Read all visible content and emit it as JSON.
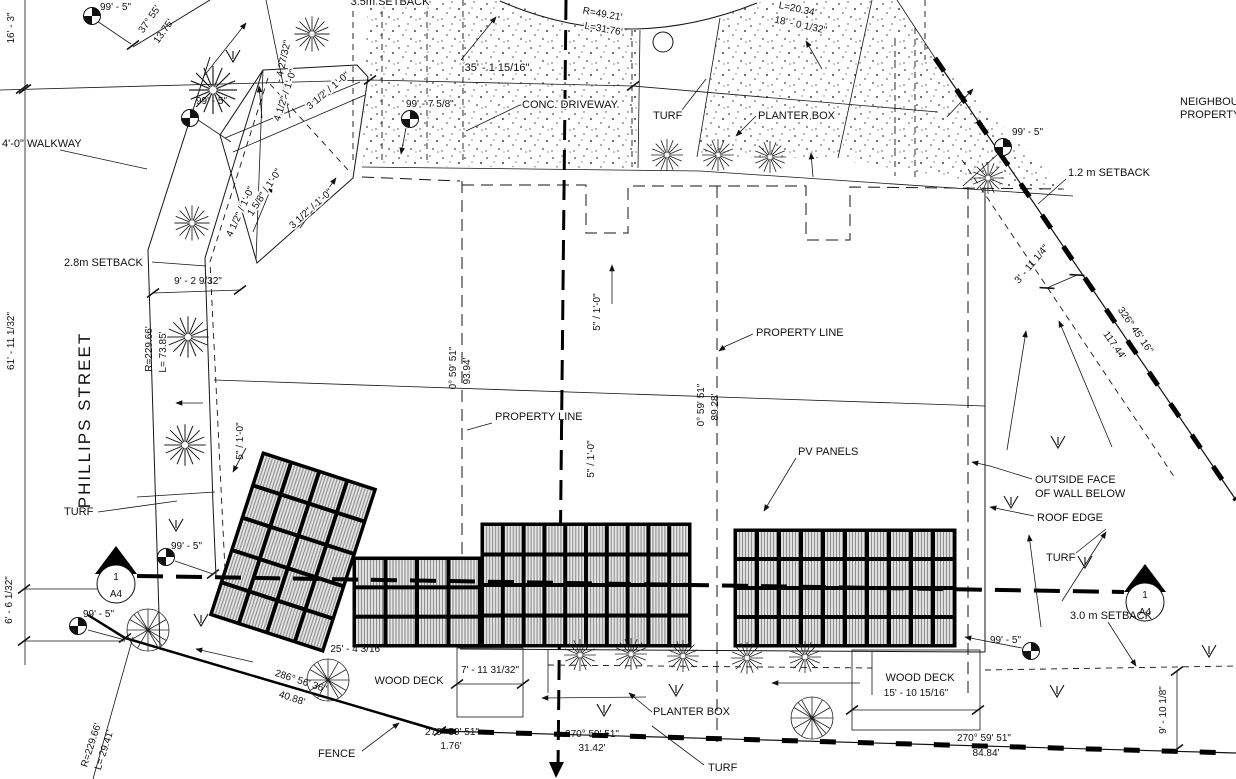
{
  "title": "Site Plan",
  "colors": {
    "ink": "#111111",
    "paper": "#ffffff",
    "panel_fill": "#e8e8e8"
  },
  "street": {
    "name": "PHILLIPS STREET"
  },
  "neighbour": {
    "line1": "NEIGHBOUR",
    "line2": "PROPERTY"
  },
  "areas": {
    "walkway": "4'-0\" WALKWAY",
    "conc_driveway": "CONC. DRIVEWAY",
    "turf": "TURF",
    "planter_box": "PLANTER BOX",
    "pv_panels": "PV PANELS",
    "wood_deck": "WOOD DECK",
    "fence": "FENCE",
    "property_line": "PROPERTY LINE",
    "outside_face_1": "OUTSIDE FACE",
    "outside_face_2": "OF WALL BELOW",
    "roof_edge": "ROOF EDGE"
  },
  "setbacks": {
    "s35": "3.5m SETBACK",
    "s28": "2.8m SETBACK",
    "s12": "1.2 m SETBACK",
    "s30": "3.0 m SETBACK"
  },
  "dims": {
    "d16_3": "16' - 3\"",
    "d61_11": "61' - 11 1/32\"",
    "d6_6": "6' - 6 1/32\"",
    "d99_5": "99' - 5\"",
    "d99_7": "99' - 7 5/8\"",
    "d35_1": "35' - 1 15/16\"",
    "d9_2": "9' - 2 9/32\"",
    "d18_0": "18' - 0 1/32\"",
    "d4_27": "- 4 27/32\"",
    "d3_11": "3' - 11 1/4\"",
    "d25_4": "25' - 4 3/16\"",
    "d7_11": "7' - 11 31/32\"",
    "d15_10": "15' - 10 15/16\"",
    "d9_10": "9' - 10 1/8\""
  },
  "curves": {
    "r49": "R=49.21'",
    "l31": "L=31.76'",
    "l20": "L=20.34'",
    "r229": "R=229.66'",
    "l73": "L= 73.85'",
    "l29": "L= 29.41'"
  },
  "bearings": {
    "a37": "37° 55'",
    "a37_len": "13.75'",
    "a0": "0° 59' 51\"",
    "a0_len1": "93.94'",
    "a0_len2": "89.28'",
    "a270": "270° 59' 51\"",
    "a270_len1": "1.76'",
    "a270_len2": "31.42'",
    "a270_len3": "84.84'",
    "a286": "286° 56' 36\"",
    "a286_len": "40.88'",
    "a326": "326° 45' 16\"",
    "a326_len": "117.44'"
  },
  "slopes": {
    "s5": "5\" / 1'-0\"",
    "s45": "4 1/2\" / 1'-0\"",
    "s35": "3 1/2\" / 1'-0\"",
    "s35ft": "3 1/2' / 1'-0\"",
    "s158": "1 5/8\" / 1'-0\""
  },
  "markers": {
    "detail_number": "1",
    "sheet": "A4"
  }
}
